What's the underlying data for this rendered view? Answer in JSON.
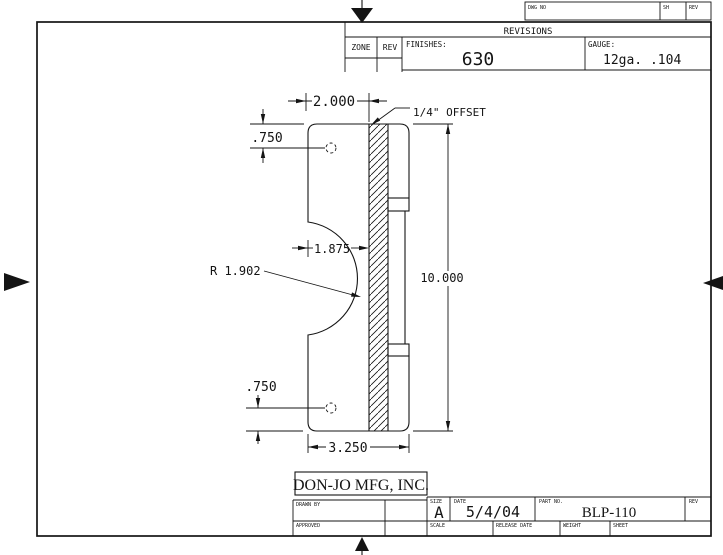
{
  "top_strip": {
    "dwg_no_label": "DWG NO",
    "sh_label": "SH",
    "rev_label": "REV"
  },
  "revisions_table": {
    "title": "REVISIONS",
    "zone_label": "ZONE",
    "rev_label": "REV",
    "finishes_label": "FINISHES:",
    "finishes_value": "630",
    "gauge_label": "GAUGE:",
    "gauge_value": "12ga. .104"
  },
  "drawing": {
    "part_name": "offset latch protector plate",
    "dim_width_top": "2.000",
    "offset_note": "1/4\" OFFSET",
    "dim_hole_top": ".750",
    "dim_cutout": "1.875",
    "radius_note": "R 1.902",
    "dim_height": "10.000",
    "dim_hole_bottom": ".750",
    "dim_width_bottom": "3.250"
  },
  "title_block": {
    "company": "DON-JO MFG, INC.",
    "drawn_by_label": "DRAWN BY",
    "approved_label": "APPROVED",
    "size_label": "SIZE",
    "size_value": "A",
    "date_label": "DATE",
    "date_value": "5/4/04",
    "part_no_label": "PART NO.",
    "part_no_value": "BLP-110",
    "rev_label": "REV",
    "scale_label": "SCALE",
    "release_date_label": "RELEASE DATE",
    "weight_label": "WEIGHT",
    "sheet_label": "SHEET"
  }
}
